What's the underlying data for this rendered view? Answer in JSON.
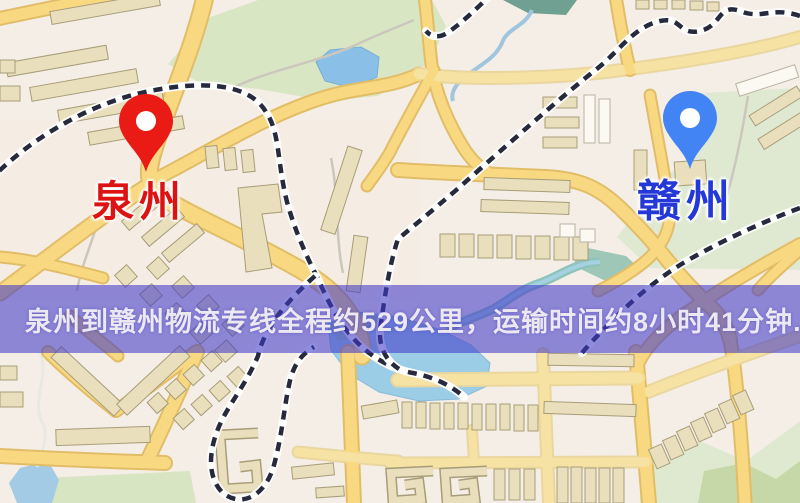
{
  "map": {
    "markers": [
      {
        "id": "quanzhou",
        "label": "泉州",
        "pin_color": "#ea1b14",
        "label_color": "#dd1212"
      },
      {
        "id": "ganzhou",
        "label": "赣州",
        "pin_color": "#4384f4",
        "label_color": "#2438d8"
      }
    ]
  },
  "banner": {
    "text": "泉州到赣州物流专线全程约529公里，运输时间约8小时41分钟.",
    "background": "rgba(66,58,200,0.58)",
    "text_color": "#ece8f2"
  },
  "colors": {
    "map_background": "#f5eee6",
    "road_fill": "#f8d981",
    "road_casing": "#e2bd68",
    "park_green": "#d9e6c3",
    "water_blue": "#9ccde6",
    "building_tan": "#e9dfbd",
    "railway_dark": "#262a3c"
  }
}
